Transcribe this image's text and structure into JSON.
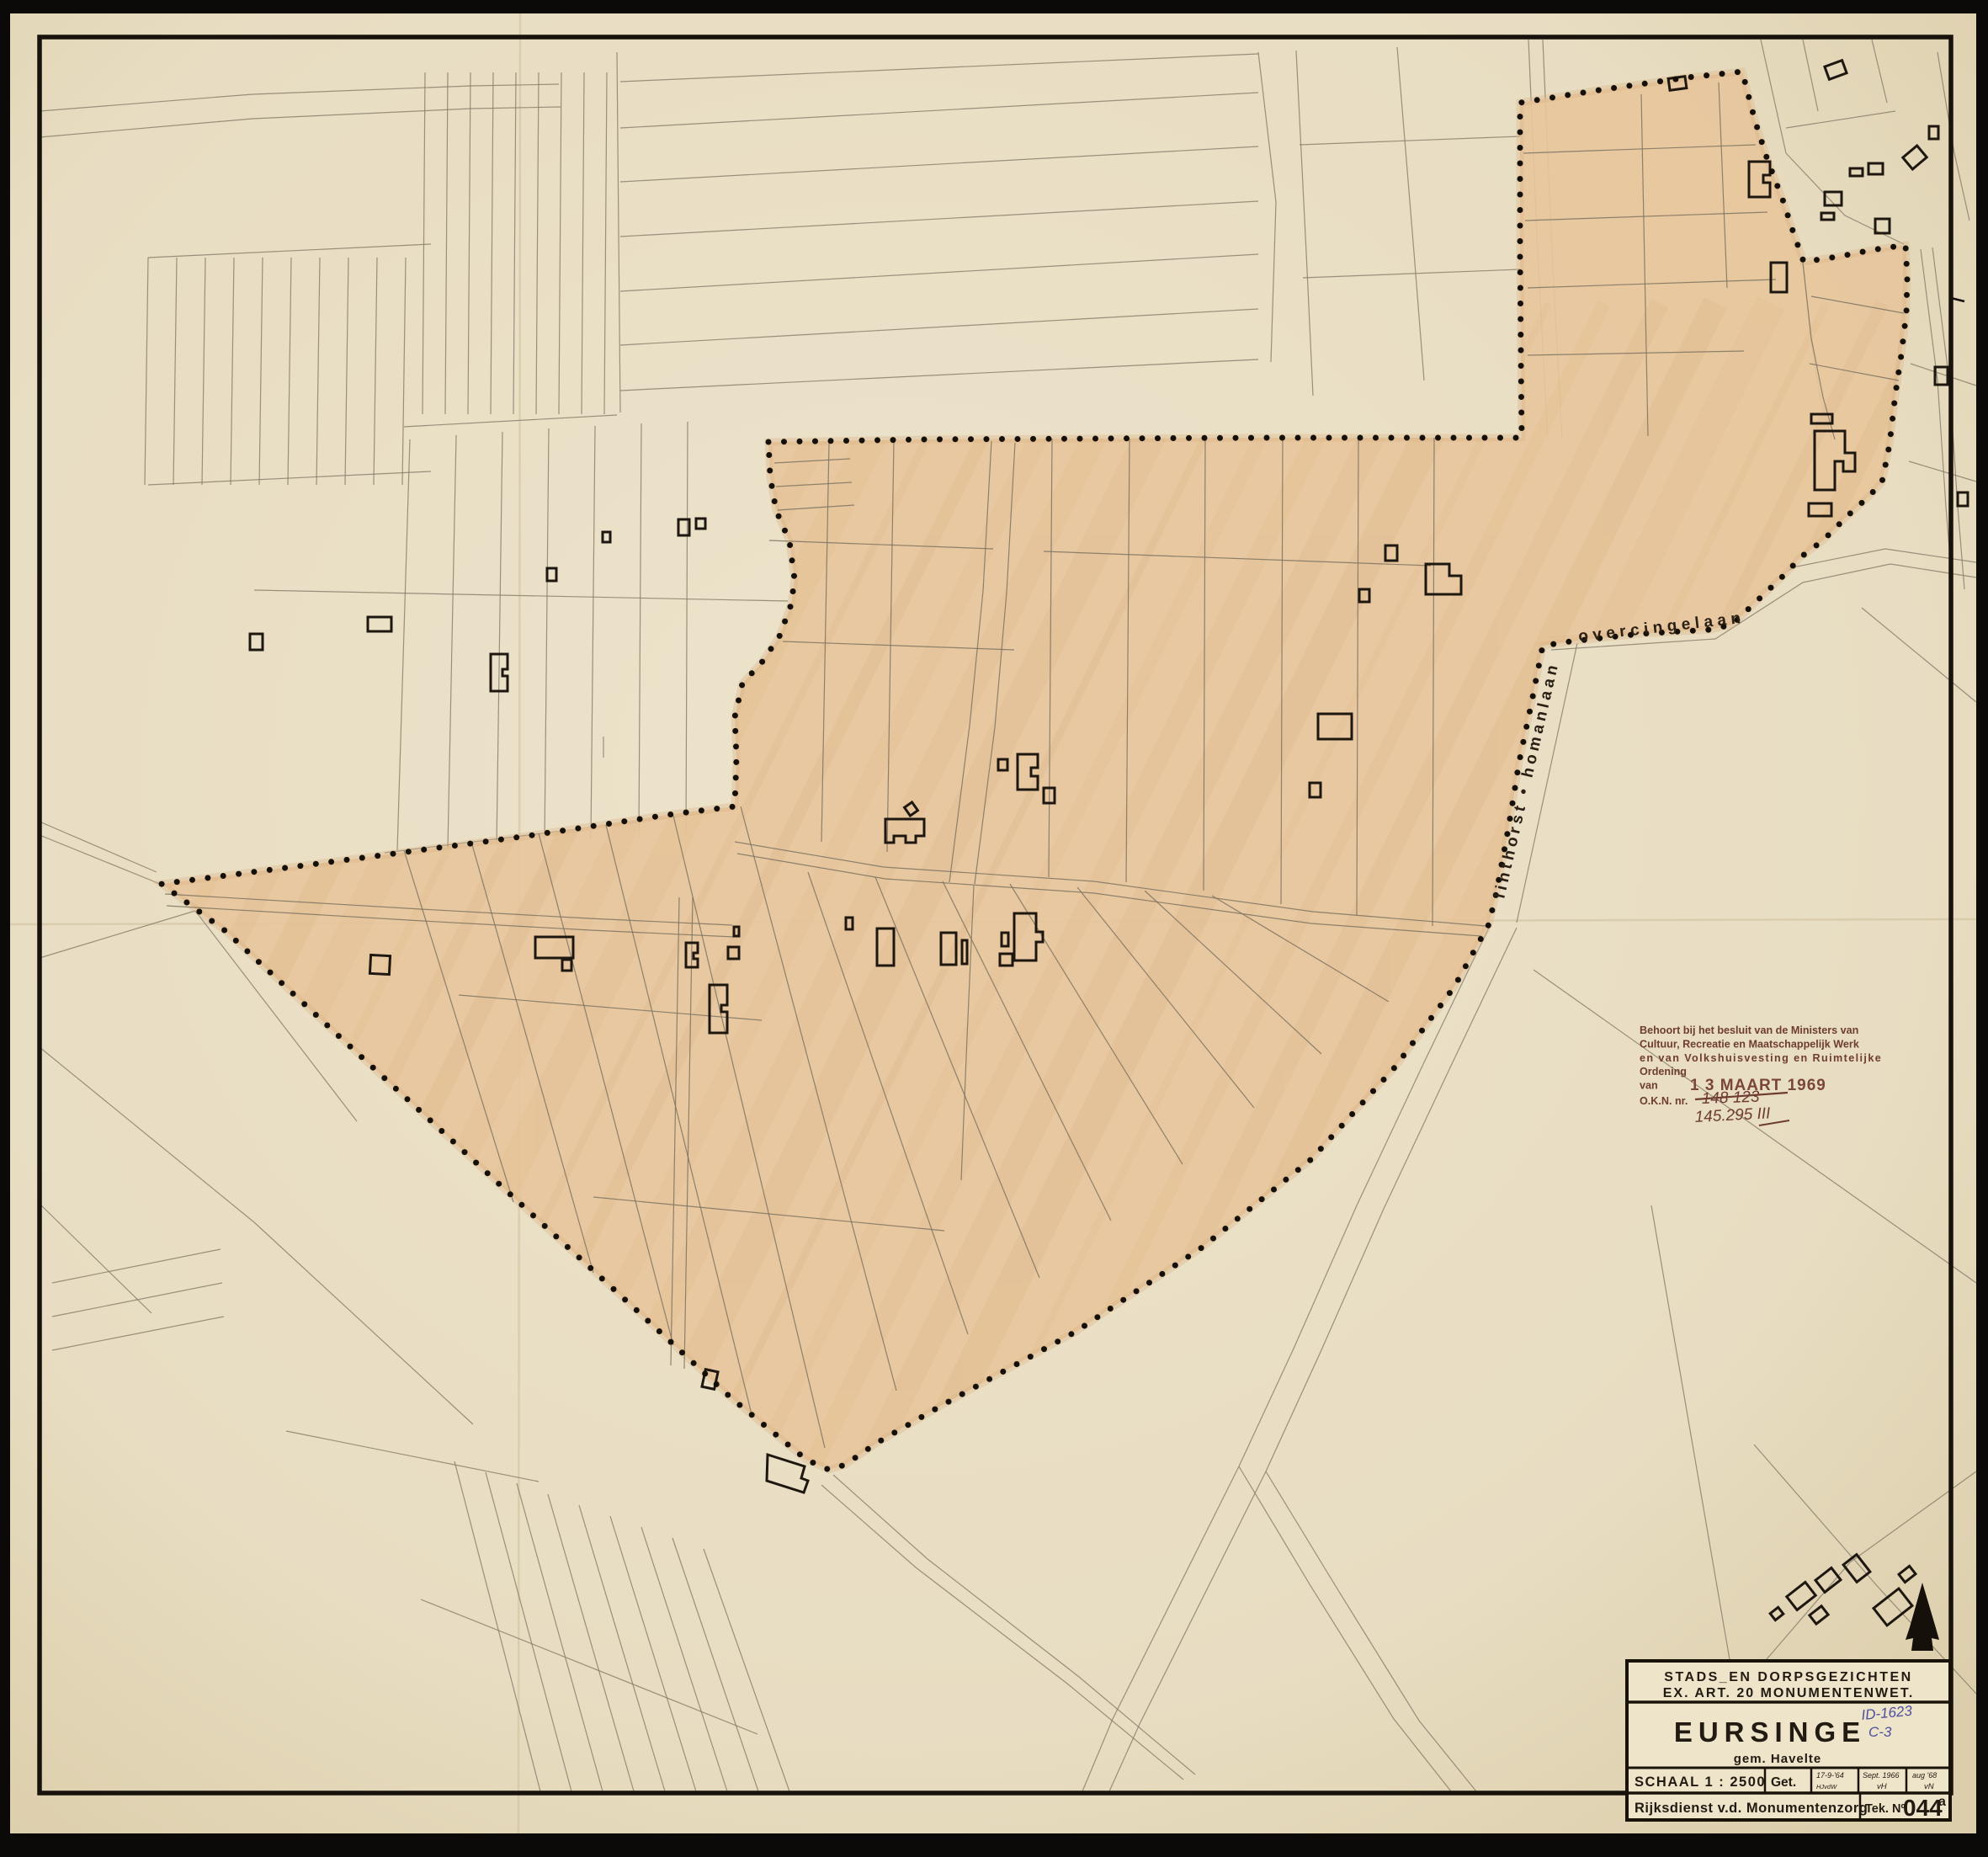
{
  "map": {
    "street_labels": [
      {
        "id": "overcingelaan",
        "text": "overcingelaan"
      },
      {
        "id": "linthorst-homanlaan",
        "text": "linthorst • homanlaan"
      }
    ]
  },
  "stamp": {
    "line1": "Behoort bij het besluit van de Ministers van",
    "line2": "Cultuur, Recreatie en Maatschappelijk Werk",
    "line3": "en van Volkshuisvesting en Ruimtelijke",
    "line4": "Ordening",
    "van_label": "van",
    "date_stamp": "1 3 MAART 1969",
    "okn_label": "O.K.N. nr.",
    "okn_old": "148 123",
    "okn_new": "145.295 III"
  },
  "title_block": {
    "header_line1": "STADS_EN DORPSGEZICHTEN",
    "header_line2": "EX. ART. 20 MONUMENTENWET.",
    "title": "EURSINGE",
    "subtitle": "gem. Havelte",
    "annotation_line1": "ID-1623",
    "annotation_line2": "C-3",
    "scale_label": "SCHAAL 1 : 2500",
    "drawn_label": "Get.",
    "revisions": [
      {
        "date": "17-9-'64",
        "initials": "HJvdW"
      },
      {
        "date": "Sept. 1966",
        "initials": "vH"
      },
      {
        "date": "aug '68",
        "initials": "vN"
      }
    ],
    "organization": "Rijksdienst v.d. Monumentenzorg",
    "drawing_number_label": "Tek. Nº",
    "drawing_number": "044",
    "drawing_number_suffix": "a"
  },
  "colors": {
    "paper": "#eae0c6",
    "paper_edge": "#d8cba8",
    "zone_fill": "#e7c69c",
    "zone_streak": "#d9b184",
    "parcel_line": "#847b69",
    "inner_line": "#7d7361",
    "ink": "#1d1710",
    "frame": "#17120c",
    "stamp": "#6e3c33",
    "stamp_date": "#7a463c",
    "annotation_blue": "#4d4f9e"
  }
}
